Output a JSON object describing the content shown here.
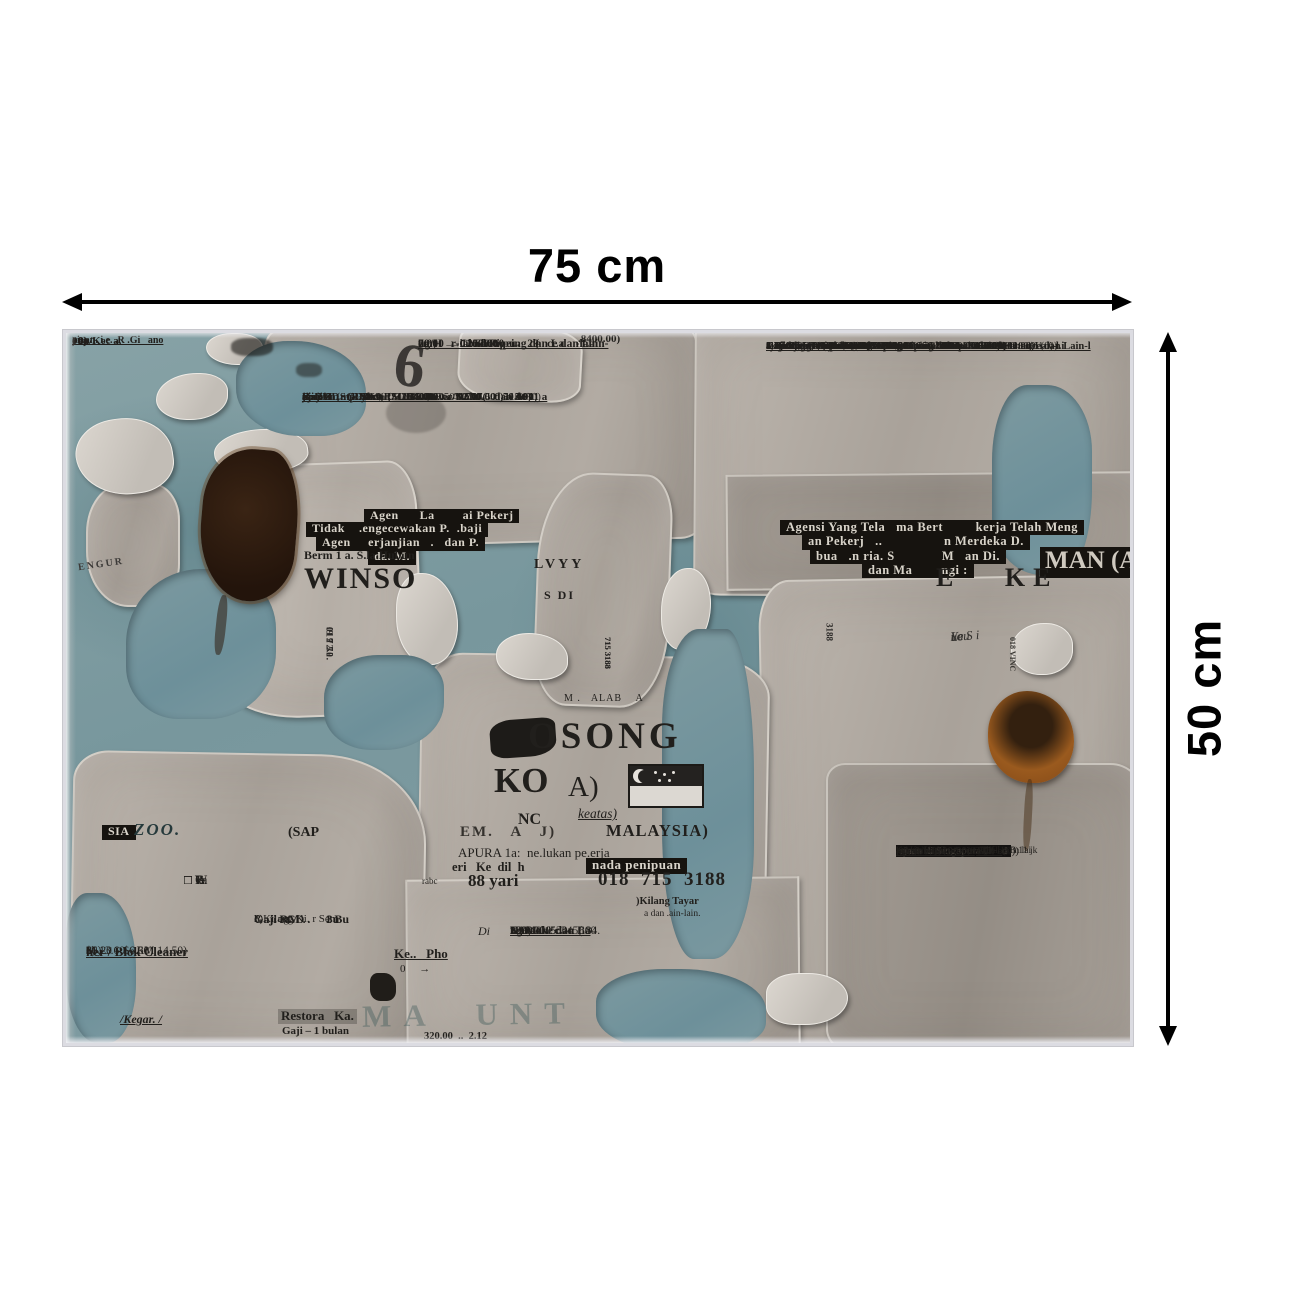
{
  "annotations": {
    "width_label": "75 cm",
    "height_label": "50 cm"
  },
  "photo": {
    "top_left": {
      "lines": [
        "ai .an. i.e. .R .Gi   ano",
        ") 0)",
        "00)",
        ". an/Kec a."
      ]
    },
    "price_top": ".8400.00)",
    "big_six": "6",
    "top_center_header": {
      "lines": [
        "ng/H      ial/Shou pu           ce dan Lain-",
        "0.00  →  1100.00             (",
        "70.00  →  2530.00  →  29",
        "em;     r-Cond/Pipeing dan La    -lain"
      ]
    },
    "top_center_main": {
      "lines": [
        "aji        (SGD30.0   →   35.00  →  40.00  →  50.00)",
        "Gaji 8      (RM69    →   80.50  →  92.00  →  115.00)",
        "Overtim    (1 jam   D5.60  →  5.50  →  7.50  →  9.30)",
        "Potoi    .mp. Tanan    2a..s/Ta..er/Kola..    dan de 11 a",
        "aj  SGD       ..d  =  (SGD .00.00   →   17(   0)",
        "ji  RM             =  (RM1840.00   →   770.00   →",
        "emud           : Insuran,h                 spa. 0ae V"
      ]
    },
    "right_column": {
      "lines": [
        "m Kuali Kopi Ke.m L...stag..  an...a.i..   .an.   .   .am",
        "Gaj      ) = 1 Pulan = (SGD900.00  →  1 00.00  →  1300.0 J    .0. (0)",
        "Ga    .1 - 11 .  n = (RM2070.00  →  2530.00  →  2990.00  →  .0 1  0)",
        "3.Cleaner/Hotel/Housekeeping  1   .ital/Shop.  .0/M. intenance dan Lain-l",
        "Gaji SGD = 1 Bulan = (SGD900.00  →  1100.00  →  1300.00)",
        "Gaji RM  = 1 Bulan = (RM2070.0   →  2530.00  →  2990 00)",
        "4.Welding/Wireman/Air-C. n  /Piping dan Lain-lain",
        "Gaji 8jam = (SGD30.00  →  35.0   →  40.00  →  50.00)",
        "Gaji 8jam = (RM69.00  →  80..0  →  92.00  →  115.00)",
        "Overtime = (1 jam SGD5.00  →  ..0  →  7.50  →  9.30)",
        "5.Potong Ramput/Tanam Pu.g./1 m      Sa m. Kol.  1 k 1.  an Lai.-l.i",
        "aji SGD = 1 Bul. n  (SGD800.00       90  . .      1200.0",
        "aji RM  = 1 Bul.   = (RM1'  0.9          76           1700.70)",
        "Kemudahan Lai. : Insura   o.d   .a. pin| 10. a     .au. Pa.   1 a.  Permit Ke .a diur"
      ]
    },
    "inverse_left": {
      "rows": [
        "Agen      La        ai Pekerj",
        "Tidak    .engecewakan P.  .baji",
        "Agen     erjanjian   .   dan P.",
        "da. M."
      ]
    },
    "inverse_right": {
      "rows": [
        "Agensi Yang Tela   ma Bert         kerja Telah Meng",
        "an Pekerj   ..                 n Merdeka D.",
        "bua   .n ria. S             M   an Di.",
        "dan Ma        ngi :"
      ],
      "big": "MAN (A"
    },
    "winson": {
      "contact": "Berm 1 a. S.la Hubun",
      "name": "WINSO",
      "tabs": [
        "012 72.",
        "019 30.",
        "012 70.",
        ".9 72."
      ],
      "side": "ENGUR"
    },
    "mid": {
      "lvyy": "LVYY",
      "sdi": "S DI",
      "tabs": [
        "715 3188",
        "715 3188",
        "715 3188"
      ],
      "alab": "M .   ALAB    A",
      "v3188": "3188",
      "ke": "E   KE",
      "hand": [
        "Le",
        "You",
        "ue S i"
      ],
      "vinc": "018 VINC"
    },
    "kosong": {
      "osong": "OSONG",
      "ko": "KO",
      "a": "A)",
      "nc": "NC",
      "keatas": "keatas)",
      "em_row": "EM.   A   J)",
      "malaysia": "MALAYSIA)",
      "sapura": "APURA 1a:  ne.lukan pe.erja",
      "keri": "eri   Ke  dil  h",
      "penipuan": "nada penipuan",
      "rabc": "rabc",
      "yari": "88 yari",
      "phone": "018  715  3188",
      "kilang_tayar": ")Kilang Tayar",
      "dan_lain": "a dan .ain-lain."
    },
    "lower_center": {
      "di": "Di",
      "kepho": "Ke..   Pho",
      "arr": "0     →",
      "lines": [
        ". 0        15.",
        "'0.00   →   345(",
        "Karaoke dan La",
        "13 0.00    →    800",
        "299).00    →    184.",
        "ng/Mai.''c",
        "1300.0.",
        ".29   -   0",
        "1 1.        530c"
      ],
      "n320": "320.00  ..  2.12",
      "ghost": "MA  UNT"
    },
    "bottom_left": {
      "sia": "SIA",
      "zoo": "ZOO.",
      "sap": "(SAP",
      "checks": [
        "□ W",
        "□ ie",
        "□ C",
        "□ 7.",
        "□ 1a",
        "□ B."
      ],
      "kilang": {
        "lines": [
          "h)Kilang Ki. r Sem",
          "Gaji SGD .     1 Bu",
          "Gaji RM .       3u",
          "R      og."
        ]
      },
      "prices": {
        "lines": [
          "$6.20 – $6.60)",
          "M 13.60 – RM 14.50)",
          "her / Blok Cleaner",
          "0)",
          "00)",
          "a'"
        ]
      },
      "kegar": "/Kegar. /",
      "restoran": "Restora   Ka.",
      "gaji_bulan": "Gaji – 1 bulan"
    },
    "bottom_right": {
      "lines": [
        "n SE     NAN.",
        "APURA 1.   m.r.t A     p",
        "rjaan di Singapura C    d",
        "laku  WINSON    0",
        "r. n dan Lai.    - in",
        "Kilang Kotak   /    er.   .)K  .g B 11 jk",
        "an; Kail k)Ki u   .   .   'Taul 1 d n lai",
        "'00  0 → 1300.       7      (0))",
        "90.0? →",
        "a' (-l",
        "> )00",
        "1840 ..",
        "nan. e"
      ]
    }
  }
}
